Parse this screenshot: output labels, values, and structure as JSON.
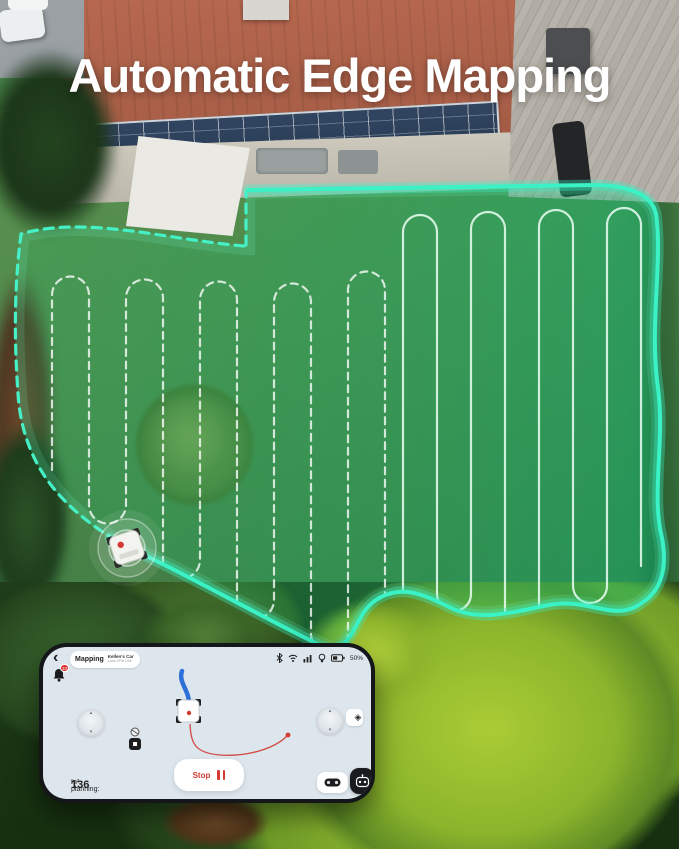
{
  "title": "Automatic Edge Mapping",
  "phone": {
    "back_icon": "‹",
    "tab_label": "Mapping",
    "device_name": "Kellen's Car",
    "device_id": "Luba-VFM D46",
    "battery_pct": "50%",
    "notification_count": "10",
    "stop_label": "Stop",
    "planning_label": "In planning:",
    "planning_value": "136",
    "planning_unit": "m²",
    "status_icons": [
      "bluetooth",
      "wifi",
      "signal",
      "bulb",
      "battery"
    ],
    "joystick_up_icon": "▴",
    "joystick_down_icon": "▾",
    "recenter_icon": "◈"
  },
  "colors": {
    "boundary_teal": "#3af2c5",
    "mapped_fill": "#17a566",
    "mow_line_white": "#eafff5",
    "robot_path_blue": "#2e6fd8",
    "accent_red": "#d23a32",
    "screen_bg": "#dde6ed"
  }
}
